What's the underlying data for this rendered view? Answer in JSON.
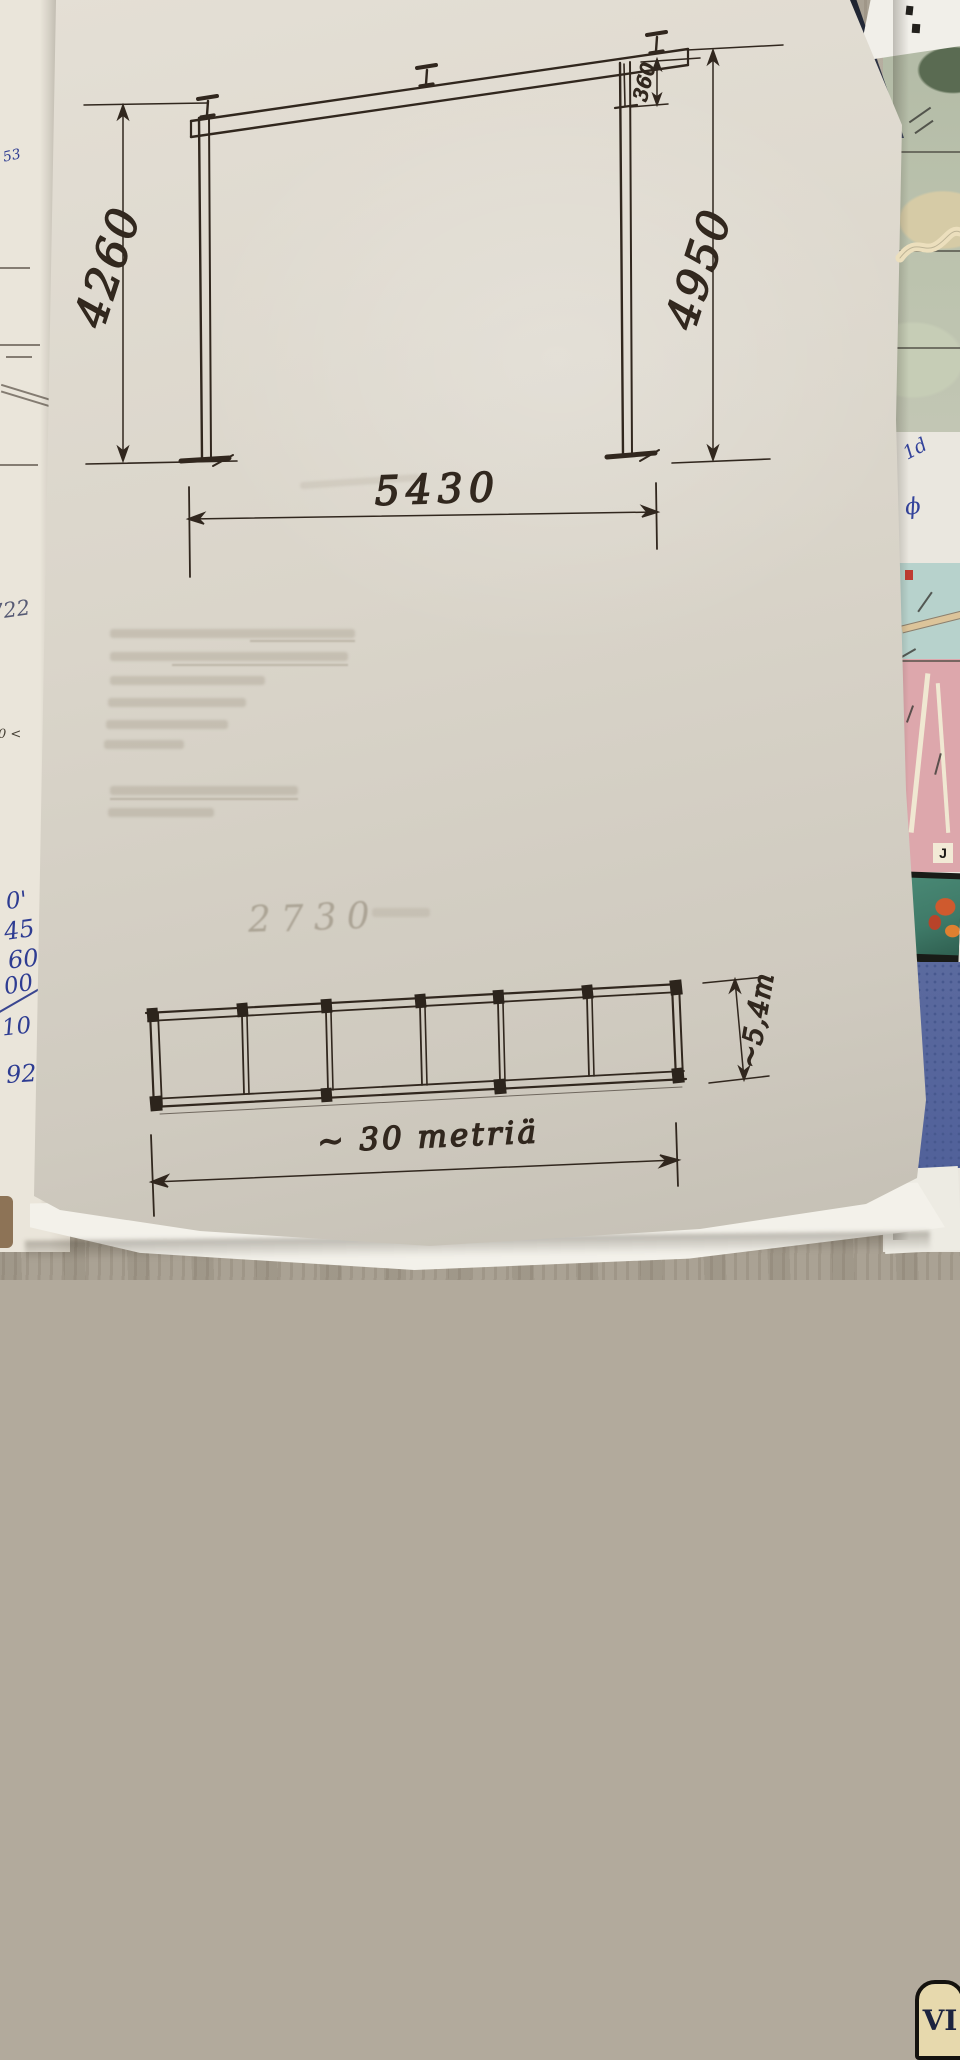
{
  "elevation": {
    "dim_left": "4260",
    "dim_right": "4950",
    "dim_depth": "360",
    "dim_span": "5430"
  },
  "plan": {
    "dim_width": "~5,4m",
    "dim_length": "~ 30 metriä",
    "faint_note": "2730"
  },
  "left_margin": {
    "note_top": "53",
    "note_mid": "722",
    "note_small": "0 <",
    "col": [
      "0'",
      "45",
      "60",
      "00",
      "10",
      "92"
    ]
  },
  "right_margin": {
    "mark_a": "1d",
    "mark_b": "ϕ"
  },
  "map": {
    "grid_letter": "J",
    "emblem": "VI",
    "fragment_1": "kkau",
    "fragment_2": "nust"
  }
}
